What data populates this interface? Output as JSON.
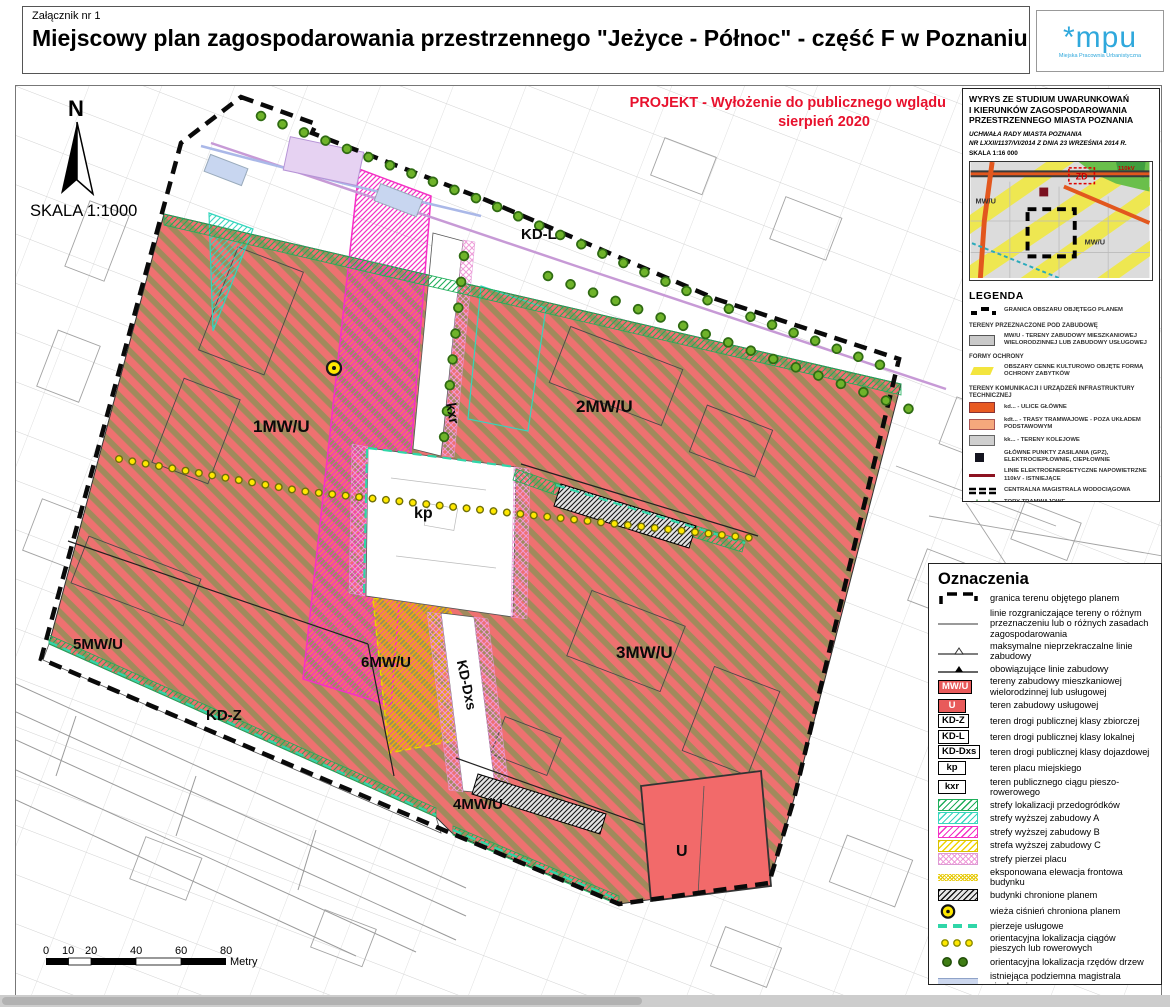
{
  "header": {
    "attachment": "Załącznik nr 1",
    "title": "Miejscowy plan zagospodarowania przestrzennego \"Jeżyce - Północ\" - część F  w Poznaniu",
    "logo_mark": "*mpu",
    "logo_tagline": "Miejska Pracownia Urbanistyczna"
  },
  "colors": {
    "mwu_fill": "#ee7170",
    "mwu_stripe": "#a18a5c",
    "u_fill": "#f26a6a",
    "boundary": "#0a0a0a",
    "accent_red": "#e8112d",
    "logo_blue": "#2fa8dc",
    "zone_a": "#38d6be",
    "zone_b": "#f431c5",
    "zone_c": "#f0d400",
    "przedogrodki": "#1fae5a",
    "pierzeje": "#2fd6a8",
    "tree_green": "#2f6b12",
    "dot_yellow": "#ffe800",
    "heat_underground": "#ccd7ee",
    "heat_overhead": "#ddc2ea"
  },
  "map": {
    "north": "N",
    "scale": "SKALA 1:1000",
    "project_note_line1": "PROJEKT - Wyłożenie do publicznego wglądu",
    "project_note_line2": "sierpień 2020",
    "scalebar": {
      "t0": "0",
      "t1": "10",
      "t2": "20",
      "t3": "40",
      "t4": "60",
      "t5": "80",
      "unit": "Metry"
    },
    "areas": {
      "a1": "1MW/U",
      "a2": "2MW/U",
      "a3": "3MW/U",
      "a4": "4MW/U",
      "a5": "5MW/U",
      "a6": "6MW/U",
      "kdl": "KD-L",
      "kdz": "KD-Z",
      "kddxs": "KD-Dxs",
      "kp": "kp",
      "kxr": "kxr",
      "u": "U"
    }
  },
  "studium": {
    "title1": "WYRYS ZE STUDIUM UWARUNKOWAŃ",
    "title2": "I KIERUNKÓW ZAGOSPODAROWANIA",
    "title3": "PRZESTRZENNEGO MIASTA POZNANIA",
    "res1": "UCHWAŁA RADY MIASTA POZNANIA",
    "res2": "NR LXXII/1137/VI/2014 Z DNIA 23 WRZEŚNIA 2014 R.",
    "scale": "SKALA 1:16 000",
    "inset": {
      "mwu_left": "MW/U",
      "mwu_right": "MW/U",
      "zd": "ZD",
      "kv": "110kV"
    }
  },
  "legenda": {
    "title": "LEGENDA",
    "item_granica": "GRANICA OBSZARU OBJĘTEGO PLANEM",
    "sec_tereny": "TERENY PRZEZNACZONE POD ZABUDOWĘ",
    "item_mwu": "MW/U - TERENY ZABUDOWY MIESZKANIOWEJ WIELORODZINNEJ LUB ZABUDOWY USŁUGOWEJ",
    "sec_formy": "FORMY OCHRONY",
    "item_obszary": "OBSZARY CENNE KULTUROWO OBJĘTE FORMĄ OCHRONY ZABYTKÓW",
    "sec_komunikacja": "TERENY KOMUNIKACJI I URZĄDZEŃ INFRASTRUKTURY TECHNICZNEJ",
    "item_kd": "kd... - ULICE GŁÓWNE",
    "item_kdt": "kdt... - TRASY TRAMWAJOWE - POZA UKŁADEM PODSTAWOWYM",
    "item_kk": "kk... - TERENY KOLEJOWE",
    "item_gpz": "GŁÓWNE PUNKTY ZASILANIA (GPZ), ELEKTROCIEPŁOWNIE, CIEPŁOWNIE",
    "item_linie": "LINIE ELEKTROENERGETYCZNE NAPOWIETRZNE 110kV - ISTNIEJĄCE",
    "item_magistrala": "CENTRALNA MAGISTRALA WODOCIĄGOWA",
    "item_tory": "TORY TRAMWAJOWE"
  },
  "oznaczenia": {
    "title": "Oznaczenia",
    "items": [
      {
        "label": "granica terenu objętego planem"
      },
      {
        "label": "linie rozgraniczające tereny o różnym przeznaczeniu lub o różnych zasadach zagospodarowania"
      },
      {
        "label": "maksymalne nieprzekraczalne linie zabudowy"
      },
      {
        "label": "obowiązujące linie zabudowy"
      },
      {
        "code": "MW/U",
        "label": "tereny zabudowy mieszkaniowej wielorodzinnej lub usługowej"
      },
      {
        "code": "U",
        "label": "teren zabudowy usługowej"
      },
      {
        "code": "KD-Z",
        "label": "teren drogi publicznej klasy zbiorczej"
      },
      {
        "code": "KD-L",
        "label": "teren drogi publicznej klasy lokalnej"
      },
      {
        "code": "KD-Dxs",
        "label": "teren drogi publicznej klasy dojazdowej"
      },
      {
        "code": "kp",
        "label": "teren placu miejskiego"
      },
      {
        "code": "kxr",
        "label": "teren publicznego ciągu pieszo-rowerowego"
      },
      {
        "label": "strefy lokalizacji przedogródków"
      },
      {
        "label": "strefy wyższej zabudowy A"
      },
      {
        "label": "strefy wyższej zabudowy B"
      },
      {
        "label": "strefa wyższej zabudowy C"
      },
      {
        "label": "strefy pierzei placu"
      },
      {
        "label": "eksponowana elewacja frontowa budynku"
      },
      {
        "label": "budynki chronione planem"
      },
      {
        "label": "wieża ciśnień chroniona planem"
      },
      {
        "label": "pierzeje usługowe"
      },
      {
        "label": "orientacyjna lokalizacja ciągów pieszych lub rowerowych"
      },
      {
        "label": "orientacyjna lokalizacja rzędów drzew"
      },
      {
        "label": "istniejąca podziemna magistrala ciepłownicza"
      },
      {
        "label": "istniejąca napowietrzna magistrala ciepłownicza"
      }
    ]
  }
}
